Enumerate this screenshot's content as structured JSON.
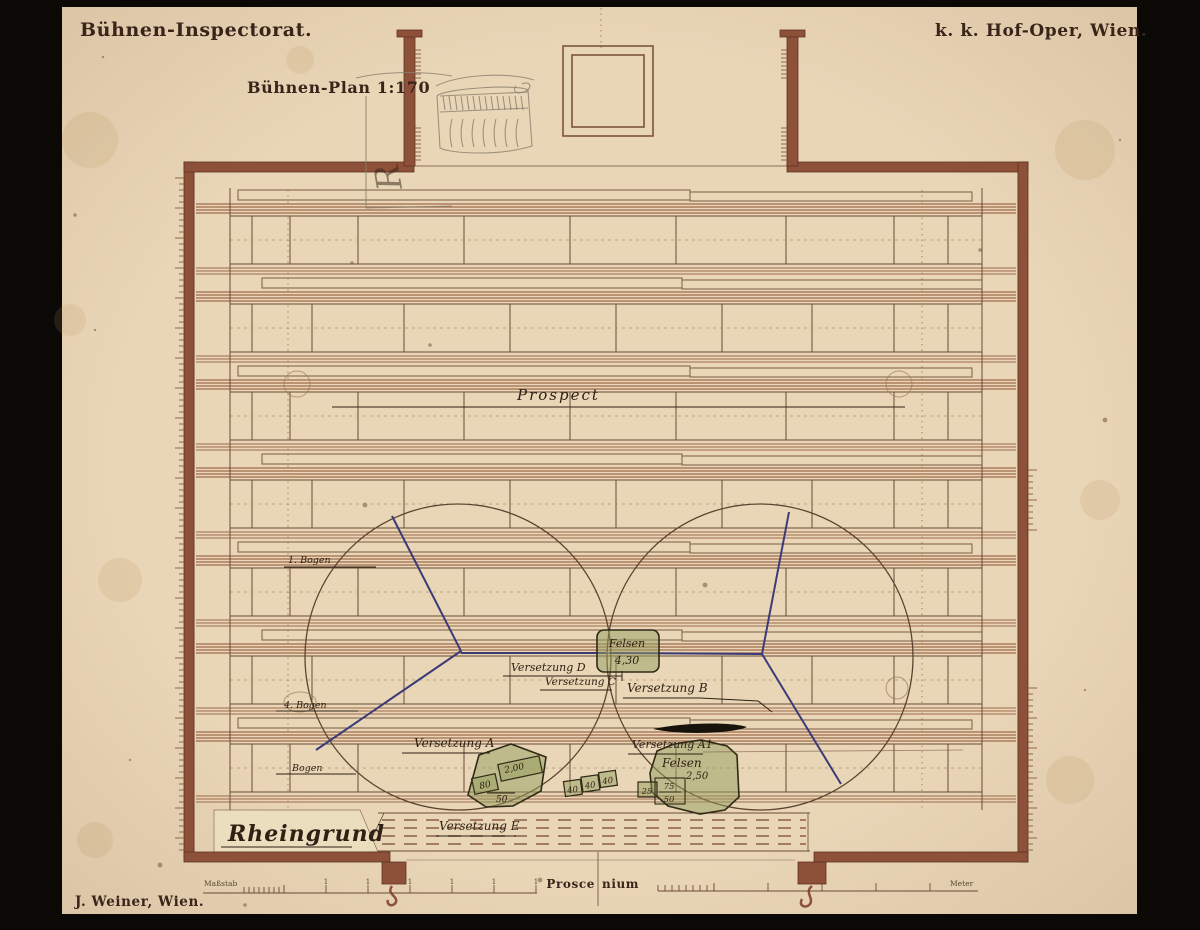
{
  "header": {
    "left_title": "Bühnen-Inspectorat.",
    "right_title": "k. k. Hof-Oper, Wien.",
    "plan_title": "Bühnen-Plan 1:170"
  },
  "plan": {
    "prospect_label": "Prospect",
    "bogen_labels": {
      "first": "1. Bogen",
      "fourth": "4. Bogen",
      "fifth": "Bogen"
    },
    "versetzung": {
      "a": "Versetzung A",
      "a1": "Versetzung A1",
      "b": "Versetzung B",
      "c": "Versetzung C",
      "d": "Versetzung D",
      "e": "Versetzung E"
    },
    "rheingrund_label": "Rheingrund",
    "felsen_box": {
      "title": "Felsen",
      "value": "4,30"
    },
    "felsen_right": {
      "title": "Felsen",
      "value": "2,50"
    },
    "rock_left": {
      "n1": "80",
      "n2": "2,00",
      "n3": "50"
    },
    "mid_boxes": [
      "40",
      "40",
      "40"
    ],
    "rock_right": {
      "n1": "25",
      "n2": "75",
      "n3": "50"
    },
    "pencil_mark": "R"
  },
  "footer": {
    "publisher": "J. Weiner, Wien.",
    "proscenium_left": "Prosce",
    "proscenium_right": "nium",
    "scale_left_label": "Maßstab",
    "scale_right_label": "Meter",
    "tick_label": "1"
  },
  "colors": {
    "paper": "#e9d6b7",
    "wall": "#8d5038",
    "ink": "#3a241a",
    "line": "#a06a4c",
    "blue": "#3b3b78",
    "green": "rgba(150,158,96,.5)"
  }
}
